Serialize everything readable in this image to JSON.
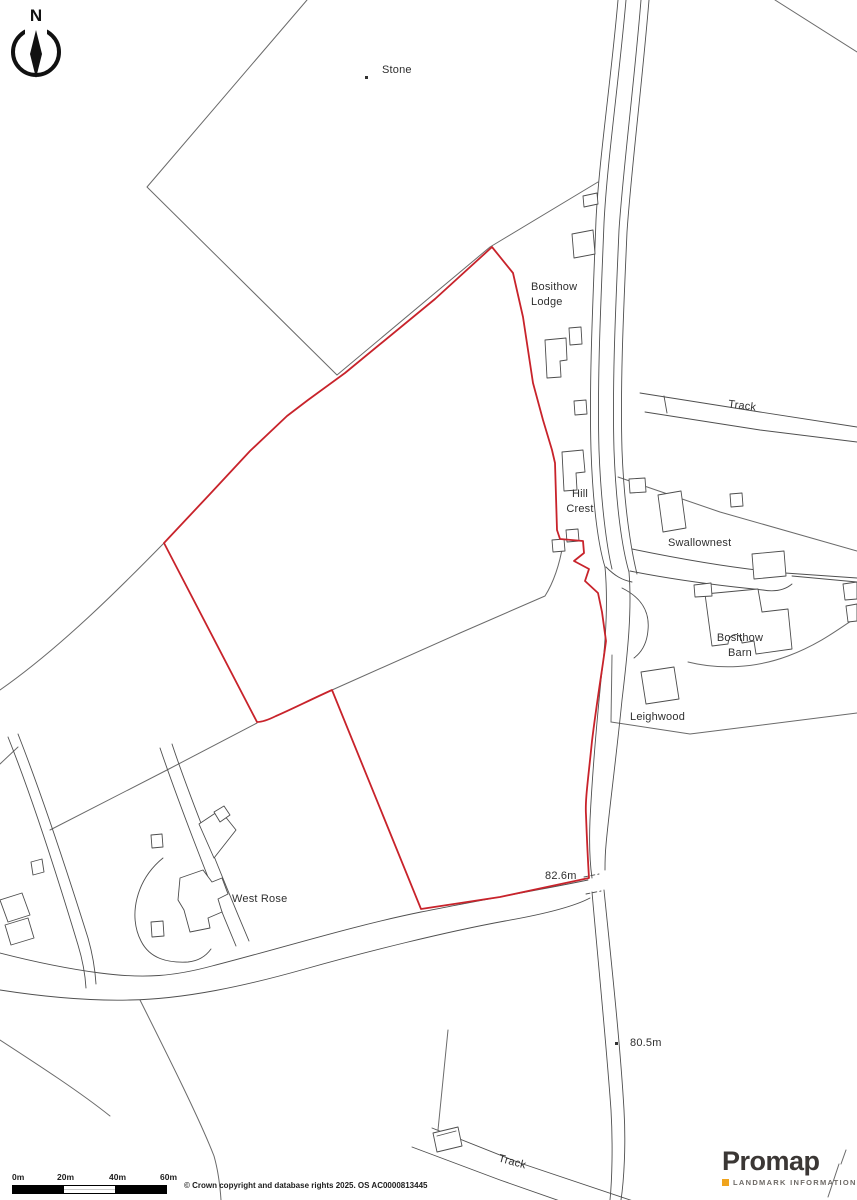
{
  "map": {
    "north_indicator": "N",
    "boundary_color": "#c8232b",
    "line_color": "#4f4f4f",
    "labels": {
      "stone": "Stone",
      "bosithow_lodge": "Bosithow\nLodge",
      "track_top": "Track",
      "hill_crest": "Hill\nCrest",
      "swallownest": "Swallownest",
      "bosithow_barn": "Bosithow\nBarn",
      "leighwood": "Leighwood",
      "west_rose": "West Rose",
      "track_bottom": "Track",
      "spot_height_upper": "82.6m",
      "spot_height_lower": "80.5m"
    }
  },
  "scale_bar": {
    "ticks": [
      "0m",
      "20m",
      "40m",
      "60m"
    ]
  },
  "attribution": {
    "copyright": "© Crown copyright and database rights 2025. OS AC0000813445"
  },
  "branding": {
    "logo": "Promap",
    "tagline": "LANDMARK INFORMATION",
    "accent_color": "#f0a41e"
  }
}
